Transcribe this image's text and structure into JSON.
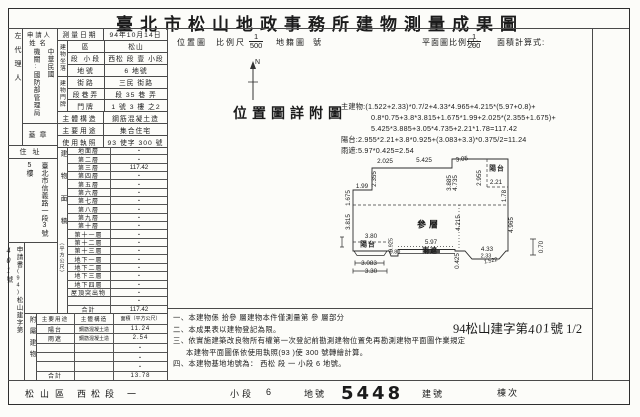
{
  "title": "臺北市松山地政事務所建物測量成果圖",
  "applicant": {
    "agent_label": "左代理人",
    "header": "申請人",
    "name_label": "姓名",
    "name_line1": "中華民國",
    "name_line2": "機關:國防部管理局",
    "seal_label": "蓋章"
  },
  "address": {
    "label": "住址",
    "line1": "臺北市信義路一段3號",
    "line2": "5樓"
  },
  "application_no": {
    "prefix": "申請書",
    "year": "(94)",
    "body": "松山建字第",
    "number": "401",
    "suffix": "號"
  },
  "survey": {
    "date_label": "測量日期",
    "date_value": "94年10月14日"
  },
  "location": {
    "section_label": "建物坐落",
    "rows": [
      {
        "label": "區",
        "value": "松山"
      },
      {
        "label": "段 小段",
        "value": "西松 段 壹 小段"
      },
      {
        "label": "地號",
        "value": "6 地號"
      }
    ]
  },
  "door": {
    "section_label": "建物門牌",
    "rows": [
      {
        "label": "街路",
        "value": "三民 街路"
      },
      {
        "label": "段巷弄",
        "value": "段 35 巷 弄"
      },
      {
        "label": "門牌",
        "value": "1 號 3 樓 之2"
      }
    ]
  },
  "structure_rows": [
    {
      "label": "主體構造",
      "value": "鋼筋混凝土造"
    },
    {
      "label": "主要用途",
      "value": "集合住宅"
    },
    {
      "label": "使用執照",
      "value": "93 使字 300 號"
    }
  ],
  "area_table": {
    "side_label": "建物面積",
    "side_sub": "（平方公尺）",
    "rows": [
      {
        "label": "地面層",
        "value": "・"
      },
      {
        "label": "第二層",
        "value": "・"
      },
      {
        "label": "第三層",
        "value": "117.42"
      },
      {
        "label": "第四層",
        "value": "・"
      },
      {
        "label": "第五層",
        "value": "・"
      },
      {
        "label": "第六層",
        "value": "・"
      },
      {
        "label": "第七層",
        "value": "・"
      },
      {
        "label": "第八層",
        "value": "・"
      },
      {
        "label": "第九層",
        "value": "・"
      },
      {
        "label": "第十層",
        "value": "・"
      },
      {
        "label": "第十一層",
        "value": "・"
      },
      {
        "label": "第十二層",
        "value": "・"
      },
      {
        "label": "第十三層",
        "value": "・"
      },
      {
        "label": "地下一層",
        "value": "・"
      },
      {
        "label": "地下二層",
        "value": "・"
      },
      {
        "label": "地下三層",
        "value": "・"
      },
      {
        "label": "地下四層",
        "value": "・"
      },
      {
        "label": "屋頂突出物",
        "value": "・"
      },
      {
        "label": "",
        "value": "・"
      },
      {
        "label": "合計",
        "value": "117.42"
      }
    ]
  },
  "attached_table": {
    "side_label": "附屬建物",
    "headers": [
      "主要用途",
      "主體構造",
      "面積（平方公尺）"
    ],
    "rows": [
      {
        "use": "陽台",
        "structure": "鋼筋混凝土造",
        "area": "11.24"
      },
      {
        "use": "雨遮",
        "structure": "鋼筋混凝土造",
        "area": "2.54"
      },
      {
        "use": "",
        "structure": "",
        "area": "・"
      },
      {
        "use": "",
        "structure": "",
        "area": "・"
      },
      {
        "use": "",
        "structure": "",
        "area": "・"
      },
      {
        "use": "合計",
        "structure": "",
        "area": "13.78"
      }
    ]
  },
  "map_header": {
    "location_map": "位置圖",
    "scale_label": "比例尺",
    "scale_num": "1",
    "scale_den": "500",
    "cadastral": "地籍圖",
    "no": "號",
    "plan_scale_label": "平面圖比例尺:",
    "plan_num": "1",
    "plan_den": "200",
    "calc_label": "面積計算式:",
    "north": "N"
  },
  "location_note": "位置圖詳附圖",
  "formulas": [
    "主建物:(1.522+2.33)*0.7/2+4.33*4.965+4.215*(5.97+0.8)+",
    "0.8*0.75+3.8*3.815+1.675*1.99+2.025*(2.355+1.675)+",
    "5.425*3.885+3.05*4.735+2.21*1.78=117.42",
    "陽台:2.955*2.21+3.8*0.925+(3.083+3.3)*0.375/2=11.24",
    "雨遮:5.97*0.425=2.54"
  ],
  "plan": {
    "floor_label": "參層",
    "labels": [
      {
        "text": "2.025"
      },
      {
        "text": "5.425"
      },
      {
        "text": "3.05"
      },
      {
        "text": "2.355"
      },
      {
        "text": "1.99"
      },
      {
        "text": "1.675"
      },
      {
        "text": "3.815"
      },
      {
        "text": "3.885"
      },
      {
        "text": "4.735"
      },
      {
        "text": "2.955"
      },
      {
        "text": "陽台"
      },
      {
        "text": "2.21"
      },
      {
        "text": "1.78"
      },
      {
        "text": "參層"
      },
      {
        "text": "4.215"
      },
      {
        "text": "4.965"
      },
      {
        "text": "3.80"
      },
      {
        "text": "陽台"
      },
      {
        "text": "0.925"
      },
      {
        "text": "0.80"
      },
      {
        "text": "5.97"
      },
      {
        "text": "雨遮"
      },
      {
        "text": "0.425"
      },
      {
        "text": "4.33"
      },
      {
        "text": "2.33"
      },
      {
        "text": "1.522"
      },
      {
        "text": "0.70"
      },
      {
        "text": "3.083"
      },
      {
        "text": "3.30"
      }
    ]
  },
  "notes": [
    "一、本建物係 拾參 層建物本件僅測量第 參 層部分",
    "二、本成果表以建物登記為限。",
    "三、依實施建築改良物所有權第一次登記前勘測建物位置免再勘測建物平面圖作業規定",
    "本建物平面圖係依使用執照(93 )使 300 號轉繪計算。",
    "四、本建物基地地號為： 西松 段 一 小段 6 地號。"
  ],
  "doc_number": {
    "prefix": "94松山建字第",
    "number": "401",
    "suffix": "號 1/2"
  },
  "footer": {
    "district": "松山區",
    "section": "西松",
    "section_unit": "段",
    "subsection": "一",
    "subsection_unit": "小段",
    "land_no": "6",
    "land_label": "地號",
    "building_no": "5448",
    "building_label": "建號",
    "unit_label": "棟次"
  }
}
